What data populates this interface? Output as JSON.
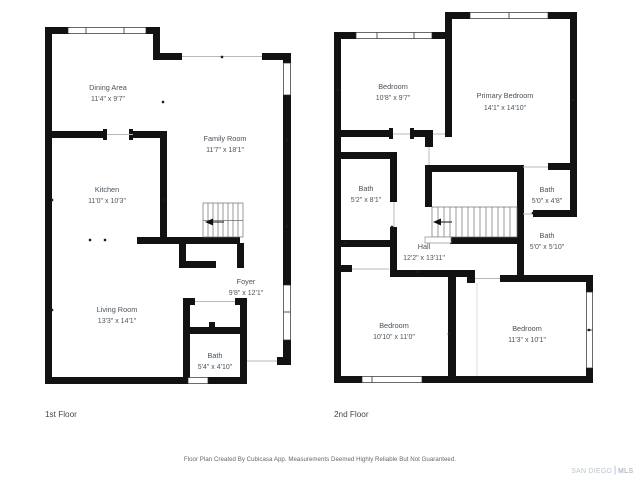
{
  "floors": [
    {
      "label": "1st Floor",
      "rooms": [
        {
          "name": "Dining Area",
          "dims": "11'4\" x 9'7\""
        },
        {
          "name": "Family Room",
          "dims": "11'7\" x 18'1\""
        },
        {
          "name": "Kitchen",
          "dims": "11'0\" x 10'3\""
        },
        {
          "name": "Living Room",
          "dims": "13'3\" x 14'1\""
        },
        {
          "name": "Foyer",
          "dims": "9'8\" x 12'1\""
        },
        {
          "name": "Bath",
          "dims": "5'4\" x 4'10\""
        }
      ]
    },
    {
      "label": "2nd Floor",
      "rooms": [
        {
          "name": "Bedroom",
          "dims": "10'8\" x 9'7\""
        },
        {
          "name": "Primary Bedroom",
          "dims": "14'1\" x 14'10\""
        },
        {
          "name": "Bath",
          "dims": "5'2\" x 8'1\""
        },
        {
          "name": "Bath",
          "dims": "5'0\" x 4'8\""
        },
        {
          "name": "Bath",
          "dims": "5'0\" x 5'10\""
        },
        {
          "name": "Hall",
          "dims": "12'2\" x 13'11\""
        },
        {
          "name": "Bedroom",
          "dims": "10'10\" x 11'0\""
        },
        {
          "name": "Bedroom",
          "dims": "11'3\" x 10'1\""
        }
      ]
    }
  ],
  "footer": {
    "disclaimer": "Floor Plan Created By Cubicasa App. Measurements Deemed Highly Reliable But Not Guaranteed.",
    "watermark": {
      "primary": "SAN DIEGO",
      "secondary": "MLS"
    }
  },
  "colors": {
    "wall": "#121212",
    "label_text": "#49525a",
    "opening_line": "#b9b9b9",
    "disclaimer_text": "#63676b",
    "watermark": "#bac6d1",
    "background": "#ffffff"
  }
}
